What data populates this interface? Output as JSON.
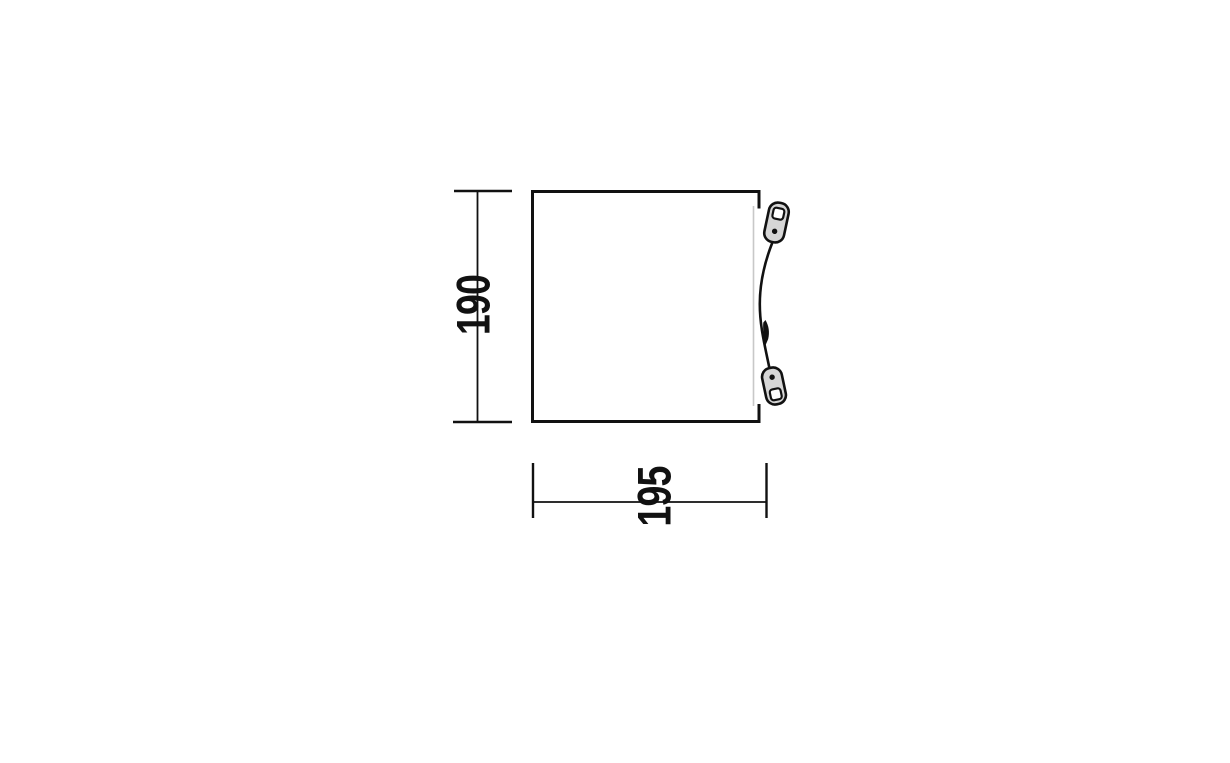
{
  "diagram": {
    "kind": "product-dimension-drawing",
    "subject": "tent-footprint-top-view",
    "dimensions": {
      "height": {
        "value": "190"
      },
      "width": {
        "value": "195"
      }
    },
    "colors": {
      "background": "#ffffff",
      "outline": "#111111",
      "dimension_line": "#111111",
      "label_text": "#111111",
      "plate_fill": "#d6d6d6",
      "plate_hole_fill": "#ffffff",
      "door_edge": "#c8c8c8"
    },
    "icons": {
      "top_anchor": "guyline-tensioner-icon",
      "bottom_anchor": "guyline-tensioner-icon",
      "mid_clip": "guyline-clip-icon"
    }
  }
}
